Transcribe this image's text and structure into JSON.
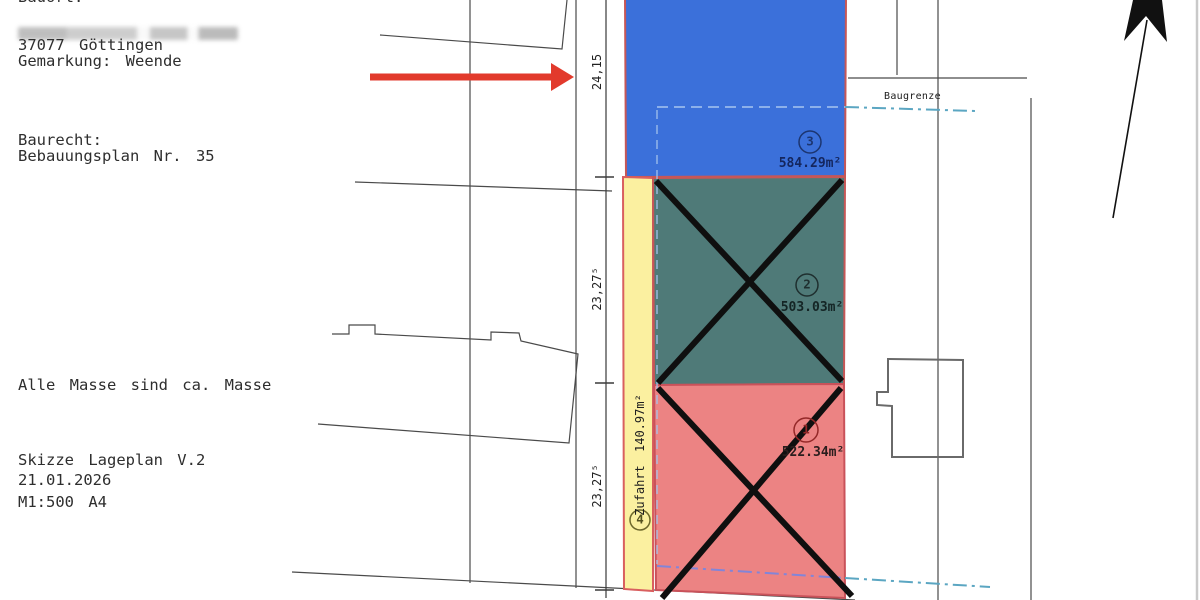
{
  "info_block": {
    "bauort_label": "Bauort:",
    "city": "37077 Göttingen",
    "gemarkung": "Gemarkung: Weende",
    "baurecht_label": "Baurecht:",
    "bebauungsplan": "Bebauungsplan Nr. 35",
    "note": "Alle Masse sind ca. Masse",
    "doc_title": "Skizze Lageplan V.2",
    "date": "21.01.2026",
    "scale": "M1:500 A4"
  },
  "parcels": {
    "p3": {
      "number": "3",
      "area": "584.29m²",
      "fill": "#3b70da"
    },
    "p2": {
      "number": "2",
      "area": "503.03m²",
      "fill": "#4f7a78"
    },
    "p1": {
      "number": "1",
      "area": "522.34m²",
      "fill": "#ec8383"
    },
    "p4": {
      "number": "4",
      "area": "140.97m²",
      "label": "Zufahrt 140.97m²",
      "fill": "#fbf0a0"
    }
  },
  "dim_labels": {
    "top": "24,15",
    "mid": "23,27⁵",
    "bottom": "23,27⁵"
  },
  "annotations": {
    "baugrenze": "Baugrenze"
  },
  "colors": {
    "parcel_border": "#c65757",
    "blue": "#3b70da",
    "green": "#4f7a78",
    "red": "#ec8383",
    "yellow": "#fbf0a0",
    "baugrenze_line": "#5ba6c2",
    "red_arrow": "#e23a2c"
  }
}
